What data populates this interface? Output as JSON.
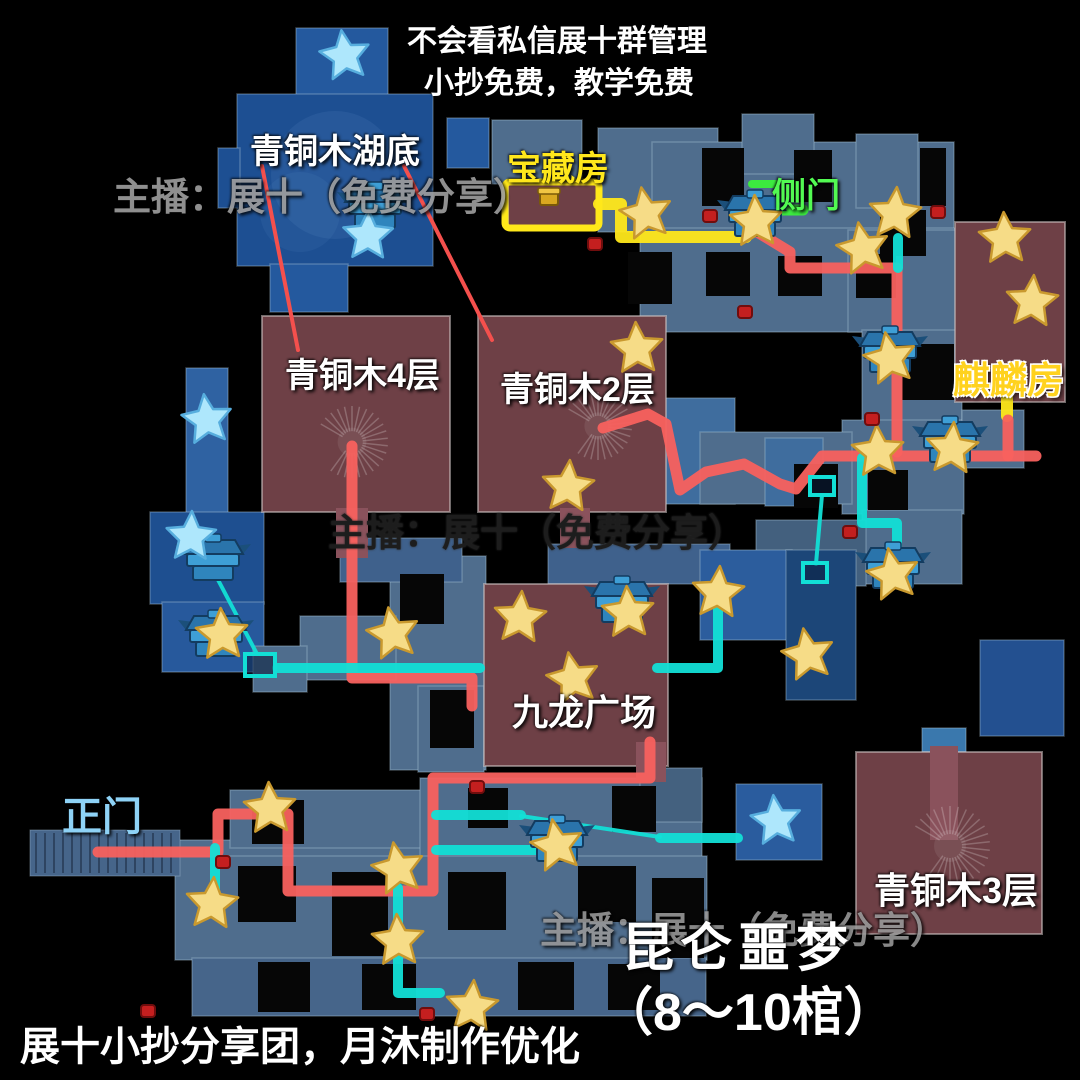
{
  "header": {
    "line1": "不会看私信展十群管理",
    "line2": "小抄免费，教学免费"
  },
  "watermark": {
    "text": "主播：展十（免费分享）"
  },
  "title": {
    "line1": "昆仑噩梦",
    "line2": "（8～10棺）"
  },
  "credit": "展十小抄分享团，月沐制作优化",
  "map_labels": {
    "lake": "青铜木湖底",
    "treasure_room": "宝藏房",
    "side_door": "侧门",
    "bronze_4f": "青铜木4层",
    "bronze_2f": "青铜木2层",
    "qilin_room": "麒麟房",
    "jiulong_plaza": "九龙广场",
    "main_gate": "正门",
    "bronze_3f": "青铜木3层"
  },
  "colors": {
    "route_main": "#f8615e",
    "route_alt": "#12dfd6",
    "route_treasure": "#ffe81a",
    "door": "#3bf13b",
    "leader": "#f4504d",
    "star_yellow": "#f6dc87",
    "star_yellow_stroke": "#c9992e",
    "star_blue": "#aee7fc",
    "star_blue_stroke": "#57aede",
    "chest_base": "#2f85bd",
    "chest_lid": "#2a74ab",
    "chest_light": "#3e9fd6",
    "chest_dark": "#133c60",
    "dot": "#c41f1f",
    "room": "#6e4046",
    "hole": "#060606"
  },
  "map_features": {
    "blocks": [
      [
        296,
        28,
        92,
        68,
        "#24599e"
      ],
      [
        237,
        94,
        196,
        172,
        "#1d4f92"
      ],
      [
        270,
        264,
        78,
        48,
        "#24599e"
      ],
      [
        447,
        118,
        42,
        50,
        "#24599e"
      ],
      [
        218,
        148,
        22,
        60,
        "#1d4f92"
      ],
      [
        186,
        368,
        42,
        150,
        "#2f62a2"
      ],
      [
        150,
        512,
        114,
        92,
        "#1e4f90"
      ],
      [
        162,
        602,
        102,
        70,
        "#27599c"
      ],
      [
        492,
        120,
        90,
        64,
        "#4f6d8d"
      ],
      [
        598,
        128,
        120,
        104,
        "#4f6d8d"
      ],
      [
        652,
        142,
        302,
        88,
        "#4f6d8d"
      ],
      [
        640,
        228,
        318,
        104,
        "#4f6d8d"
      ],
      [
        742,
        114,
        72,
        60,
        "#4f6d8d"
      ],
      [
        856,
        134,
        62,
        74,
        "#4f6d8d"
      ],
      [
        848,
        230,
        114,
        102,
        "#4f6d8d"
      ],
      [
        862,
        330,
        100,
        132,
        "#4f6d8d"
      ],
      [
        842,
        420,
        122,
        94,
        "#4f6d8d"
      ],
      [
        862,
        510,
        100,
        74,
        "#4f6d8d"
      ],
      [
        756,
        520,
        110,
        66,
        "#43607e"
      ],
      [
        663,
        398,
        72,
        106,
        "#3f6d9e"
      ],
      [
        700,
        432,
        152,
        72,
        "#4f6d8d"
      ],
      [
        765,
        438,
        58,
        68,
        "#3f6d9e"
      ],
      [
        962,
        410,
        62,
        58,
        "#4f6d8d"
      ],
      [
        390,
        556,
        96,
        214,
        "#4f6d8d"
      ],
      [
        300,
        616,
        96,
        64,
        "#4f6d8d"
      ],
      [
        253,
        646,
        54,
        46,
        "#4f6d8d"
      ],
      [
        418,
        686,
        66,
        86,
        "#4f6d8d"
      ],
      [
        340,
        538,
        122,
        44,
        "#3f618c"
      ],
      [
        548,
        544,
        182,
        40,
        "#3f618c"
      ],
      [
        700,
        550,
        92,
        90,
        "#2c5d9d"
      ],
      [
        786,
        550,
        70,
        150,
        "#1c4678"
      ],
      [
        980,
        640,
        84,
        96,
        "#235090"
      ],
      [
        178,
        840,
        252,
        24,
        "#4f6d8d"
      ],
      [
        230,
        790,
        192,
        58,
        "#4f6d8d"
      ],
      [
        420,
        778,
        282,
        90,
        "#4f6d8d"
      ],
      [
        175,
        856,
        532,
        104,
        "#4f6d8d"
      ],
      [
        192,
        958,
        514,
        58,
        "#46658a"
      ],
      [
        736,
        784,
        86,
        76,
        "#2a5c9e"
      ],
      [
        640,
        768,
        62,
        54,
        "#44617f"
      ],
      [
        922,
        728,
        44,
        24,
        "#3a78ad"
      ]
    ],
    "holes": [
      [
        702,
        148,
        42,
        58
      ],
      [
        794,
        150,
        38,
        52
      ],
      [
        880,
        210,
        46,
        46
      ],
      [
        628,
        252,
        44,
        52
      ],
      [
        706,
        252,
        44,
        44
      ],
      [
        778,
        256,
        44,
        40
      ],
      [
        856,
        254,
        40,
        44
      ],
      [
        920,
        148,
        26,
        58
      ],
      [
        902,
        344,
        52,
        56
      ],
      [
        868,
        470,
        40,
        40
      ],
      [
        794,
        464,
        44,
        44
      ],
      [
        400,
        574,
        44,
        50
      ],
      [
        430,
        690,
        44,
        58
      ],
      [
        238,
        866,
        58,
        56
      ],
      [
        332,
        872,
        56,
        84
      ],
      [
        448,
        872,
        58,
        58
      ],
      [
        578,
        866,
        58,
        56
      ],
      [
        652,
        878,
        52,
        80
      ],
      [
        258,
        962,
        52,
        50
      ],
      [
        362,
        964,
        54,
        46
      ],
      [
        518,
        962,
        56,
        48
      ],
      [
        608,
        964,
        52,
        46
      ],
      [
        468,
        788,
        40,
        40
      ],
      [
        612,
        786,
        44,
        46
      ],
      [
        252,
        800,
        52,
        44
      ]
    ],
    "rooms": [
      [
        262,
        316,
        188,
        196
      ],
      [
        478,
        316,
        188,
        196
      ],
      [
        508,
        184,
        90,
        42
      ],
      [
        484,
        584,
        184,
        182
      ],
      [
        856,
        752,
        186,
        182
      ],
      [
        955,
        222,
        110,
        180
      ]
    ],
    "connectors": [
      [
        336,
        508,
        32,
        50
      ],
      [
        560,
        508,
        30,
        40
      ],
      [
        930,
        746,
        28,
        94
      ],
      [
        636,
        742,
        30,
        40
      ]
    ],
    "pier": [
      30,
      830,
      150,
      46
    ],
    "spirals": [
      [
        352,
        442,
        36
      ],
      [
        598,
        426,
        34
      ],
      [
        950,
        846,
        40
      ]
    ],
    "routes": [
      {
        "name": "treasure-route-1",
        "color": "route_treasure",
        "width": 12,
        "points": [
          [
            599,
            204
          ],
          [
            621,
            204
          ],
          [
            621,
            237
          ],
          [
            746,
            237
          ]
        ]
      },
      {
        "name": "treasure-route-qilin-mark",
        "color": "route_treasure",
        "width": 12,
        "points": [
          [
            1007,
            388
          ],
          [
            1007,
            416
          ]
        ]
      },
      {
        "name": "main-route-gate",
        "color": "route_main",
        "width": 11,
        "points": [
          [
            98,
            852
          ],
          [
            218,
            852
          ],
          [
            218,
            814
          ],
          [
            288,
            814
          ],
          [
            288,
            891
          ],
          [
            433,
            891
          ],
          [
            433,
            778
          ],
          [
            650,
            778
          ],
          [
            650,
            742
          ]
        ]
      },
      {
        "name": "main-route-bronze4",
        "color": "route_main",
        "width": 11,
        "points": [
          [
            352,
            446
          ],
          [
            352,
            678
          ],
          [
            472,
            678
          ],
          [
            472,
            706
          ]
        ]
      },
      {
        "name": "main-route-bronze2-east",
        "color": "route_main",
        "width": 11,
        "points": [
          [
            603,
            428
          ],
          [
            648,
            414
          ],
          [
            666,
            424
          ],
          [
            680,
            490
          ],
          [
            706,
            472
          ],
          [
            744,
            464
          ],
          [
            780,
            484
          ],
          [
            796,
            489
          ],
          [
            822,
            456
          ],
          [
            1036,
            456
          ]
        ]
      },
      {
        "name": "main-route-qilin-branch",
        "color": "route_main",
        "width": 11,
        "points": [
          [
            1008,
            456
          ],
          [
            1008,
            420
          ]
        ]
      },
      {
        "name": "main-route-sidedoor",
        "color": "route_main",
        "width": 11,
        "points": [
          [
            754,
            230
          ],
          [
            790,
            252
          ],
          [
            790,
            268
          ],
          [
            897,
            268
          ],
          [
            897,
            452
          ]
        ]
      },
      {
        "name": "alt-route-1",
        "color": "route_alt",
        "width": 10,
        "points": [
          [
            215,
            848
          ],
          [
            215,
            897
          ]
        ]
      },
      {
        "name": "alt-route-2",
        "color": "route_alt",
        "width": 10,
        "points": [
          [
            398,
            888
          ],
          [
            398,
            993
          ],
          [
            440,
            993
          ]
        ]
      },
      {
        "name": "alt-route-3",
        "color": "route_alt",
        "width": 10,
        "points": [
          [
            436,
            815
          ],
          [
            521,
            815
          ]
        ]
      },
      {
        "name": "alt-route-4",
        "color": "route_alt",
        "width": 10,
        "points": [
          [
            436,
            850
          ],
          [
            543,
            850
          ]
        ]
      },
      {
        "name": "alt-route-5",
        "color": "route_alt",
        "width": 10,
        "points": [
          [
            660,
            838
          ],
          [
            738,
            838
          ]
        ]
      },
      {
        "name": "alt-route-plaza",
        "color": "route_alt",
        "width": 10,
        "points": [
          [
            718,
            602
          ],
          [
            718,
            668
          ],
          [
            657,
            668
          ]
        ]
      },
      {
        "name": "alt-route-east",
        "color": "route_alt",
        "width": 10,
        "points": [
          [
            862,
            458
          ],
          [
            862,
            523
          ],
          [
            897,
            523
          ],
          [
            897,
            566
          ]
        ]
      },
      {
        "name": "alt-route-6",
        "color": "route_alt",
        "width": 10,
        "points": [
          [
            898,
            238
          ],
          [
            898,
            268
          ]
        ]
      },
      {
        "name": "alt-route-west",
        "color": "route_alt",
        "width": 10,
        "points": [
          [
            277,
            668
          ],
          [
            480,
            668
          ]
        ]
      },
      {
        "name": "alt-link-1",
        "color": "route_alt",
        "width": 4,
        "points": [
          [
            521,
            816
          ],
          [
            660,
            837
          ]
        ]
      },
      {
        "name": "alt-link-2",
        "color": "route_alt",
        "width": 4,
        "points": [
          [
            216,
            576
          ],
          [
            257,
            654
          ]
        ]
      },
      {
        "name": "alt-link-3",
        "color": "route_alt",
        "width": 4,
        "points": [
          [
            822,
            495
          ],
          [
            816,
            564
          ]
        ]
      },
      {
        "name": "side-door-mark",
        "color": "door",
        "width": 11,
        "points": [
          [
            777,
            210
          ],
          [
            803,
            210
          ]
        ]
      },
      {
        "name": "side-door-map",
        "color": "door",
        "width": 8,
        "points": [
          [
            752,
            184
          ],
          [
            776,
            184
          ]
        ]
      }
    ],
    "treasure_box": [
      505,
      182,
      94,
      46
    ],
    "teleports": {
      "rects": [
        [
          197,
          553,
          32,
          22
        ],
        [
          245,
          654,
          30,
          22
        ],
        [
          810,
          477,
          24,
          18
        ],
        [
          803,
          563,
          24,
          19
        ]
      ]
    },
    "leader_lines": [
      [
        262,
        166,
        298,
        350
      ],
      [
        404,
        166,
        492,
        340
      ]
    ],
    "chests": [
      [
        375,
        210
      ],
      [
        755,
        218
      ],
      [
        890,
        354
      ],
      [
        950,
        444
      ],
      [
        893,
        570
      ],
      [
        622,
        604
      ],
      [
        213,
        562
      ],
      [
        216,
        638
      ],
      [
        557,
        843
      ]
    ],
    "gold_chest": [
      549,
      198
    ],
    "stars_yellow": [
      [
        646,
        214
      ],
      [
        756,
        222
      ],
      [
        895,
        214
      ],
      [
        863,
        249
      ],
      [
        1005,
        239
      ],
      [
        1032,
        302
      ],
      [
        890,
        359
      ],
      [
        637,
        349
      ],
      [
        568,
        487
      ],
      [
        393,
        634
      ],
      [
        222,
        635
      ],
      [
        520,
        618
      ],
      [
        573,
        679
      ],
      [
        628,
        613
      ],
      [
        718,
        593
      ],
      [
        808,
        655
      ],
      [
        878,
        452
      ],
      [
        952,
        449
      ],
      [
        893,
        575
      ],
      [
        270,
        809
      ],
      [
        212,
        904
      ],
      [
        398,
        869
      ],
      [
        398,
        941
      ],
      [
        472,
        1007
      ],
      [
        557,
        846
      ]
    ],
    "stars_blue": [
      [
        345,
        56
      ],
      [
        368,
        236
      ],
      [
        207,
        420
      ],
      [
        191,
        537
      ],
      [
        776,
        821
      ]
    ],
    "dots": [
      [
        710,
        216
      ],
      [
        938,
        212
      ],
      [
        745,
        312
      ],
      [
        872,
        419
      ],
      [
        850,
        532
      ],
      [
        477,
        787
      ],
      [
        223,
        862
      ],
      [
        427,
        1014
      ],
      [
        148,
        1011
      ],
      [
        595,
        244
      ]
    ]
  }
}
